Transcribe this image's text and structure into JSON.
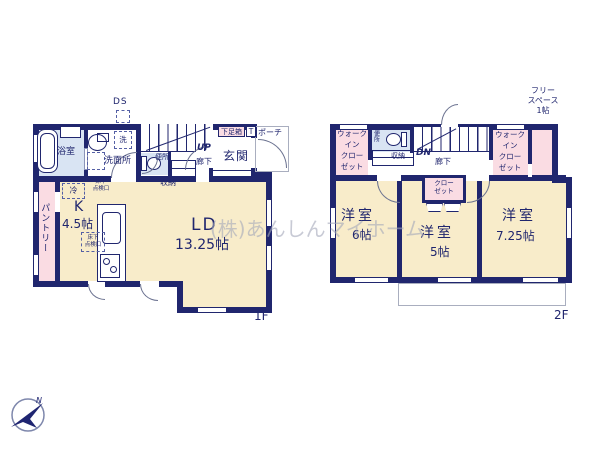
{
  "type": "floor_plan",
  "watermark": "(株)あんしんマイホーム",
  "compass": {
    "label": "N"
  },
  "colors": {
    "wall": "#20266e",
    "room_cream": "#f8ecca",
    "room_pink": "#fadce3",
    "room_blue": "#d9e4f3",
    "watermark_gray": "#a4a8ba"
  },
  "f1": {
    "label": "1F",
    "rooms": {
      "bath": "浴室",
      "washroom": "洗面所",
      "washer": "洗",
      "ps": "PS",
      "ds": "DS",
      "toilet": "便所",
      "up": "UP",
      "hallway": "廊下",
      "storage": "収納",
      "shoe_box": "下足箱",
      "t": "T",
      "porch": "ポーチ",
      "entrance": "玄関",
      "underfloor_hatch": "床下\n点検口",
      "fridge": "冷",
      "kitchen": "K",
      "kitchen_size": "4.5帖",
      "pantry": "パントリー",
      "living": "LD",
      "living_size": "13.25帖"
    }
  },
  "f2": {
    "label": "2F",
    "rooms": {
      "wic": "ウォーク\nイン\nクロー\nゼット",
      "toilet": "便所",
      "storage": "収納",
      "dn": "DN",
      "hallway": "廊下",
      "free_space": "フリー\nスペース\n1帖",
      "closet": "クロー\nゼット",
      "bedroom1": "洋室",
      "bedroom1_size": "6帖",
      "bedroom2": "洋室",
      "bedroom2_size": "5帖",
      "bedroom3": "洋室",
      "bedroom3_size": "7.25帖"
    }
  }
}
